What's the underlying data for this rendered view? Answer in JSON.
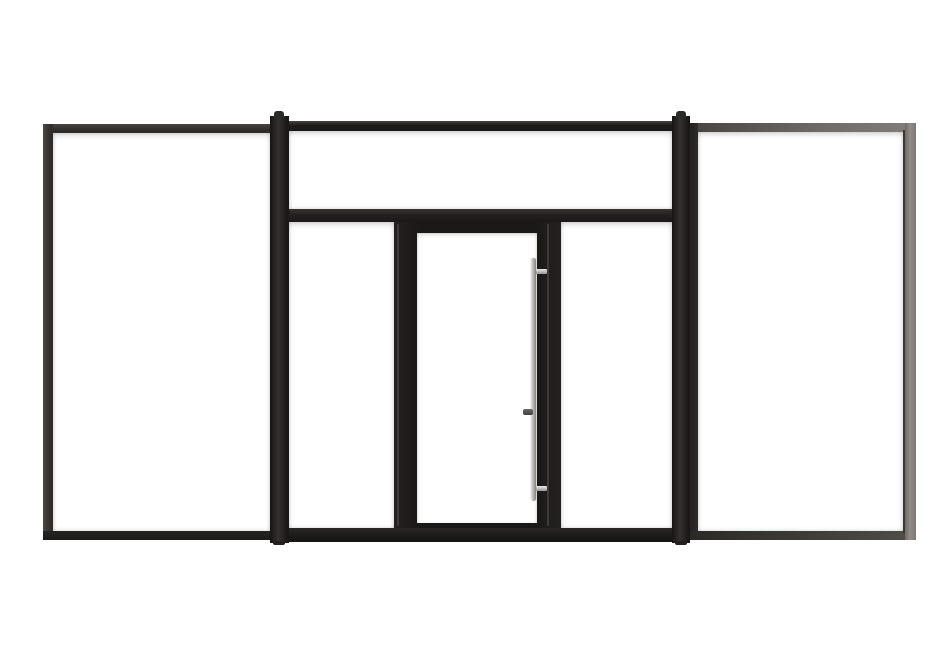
{
  "scene": {
    "description": "Front-view 3D product render of a black aluminium glazed entry system on a white background: a large fixed glass panel on each side, and a centre section with a full-width transom window above a glazed single door flanked by two narrow sidelights. The door carries a vertical stainless-steel pull handle with a small lock knob.",
    "background_color": "#ffffff"
  },
  "colors": {
    "frame_black": "#1b1918",
    "frame_black_highlight": "#47433e",
    "left_panel_frame": "#37332f",
    "right_panel_frame_top": "#6e6965",
    "right_panel_frame_side": "#918c88",
    "right_panel_frame_bottom": "#2b2926",
    "mullion": "#232120",
    "glass": "#ffffff",
    "handle_silver_light": "#e4e2de",
    "handle_silver_dark": "#87847f",
    "lock_knob": "#57534f"
  },
  "components": {
    "left_fixed_panel": "Left fixed glazed panel",
    "left_mullion": "Left structural mullion",
    "transom": "Transom window",
    "left_sidelight": "Left sidelight",
    "door": "Glazed entry door",
    "door_glass": "Door glazing",
    "handle": "Vertical pull handle",
    "handle_bracket_top": "Handle top mount",
    "handle_bracket_bottom": "Handle bottom mount",
    "lock_knob": "Lock cylinder knob",
    "right_sidelight": "Right sidelight",
    "right_mullion": "Right structural mullion",
    "right_fixed_panel": "Right fixed glazed panel"
  }
}
